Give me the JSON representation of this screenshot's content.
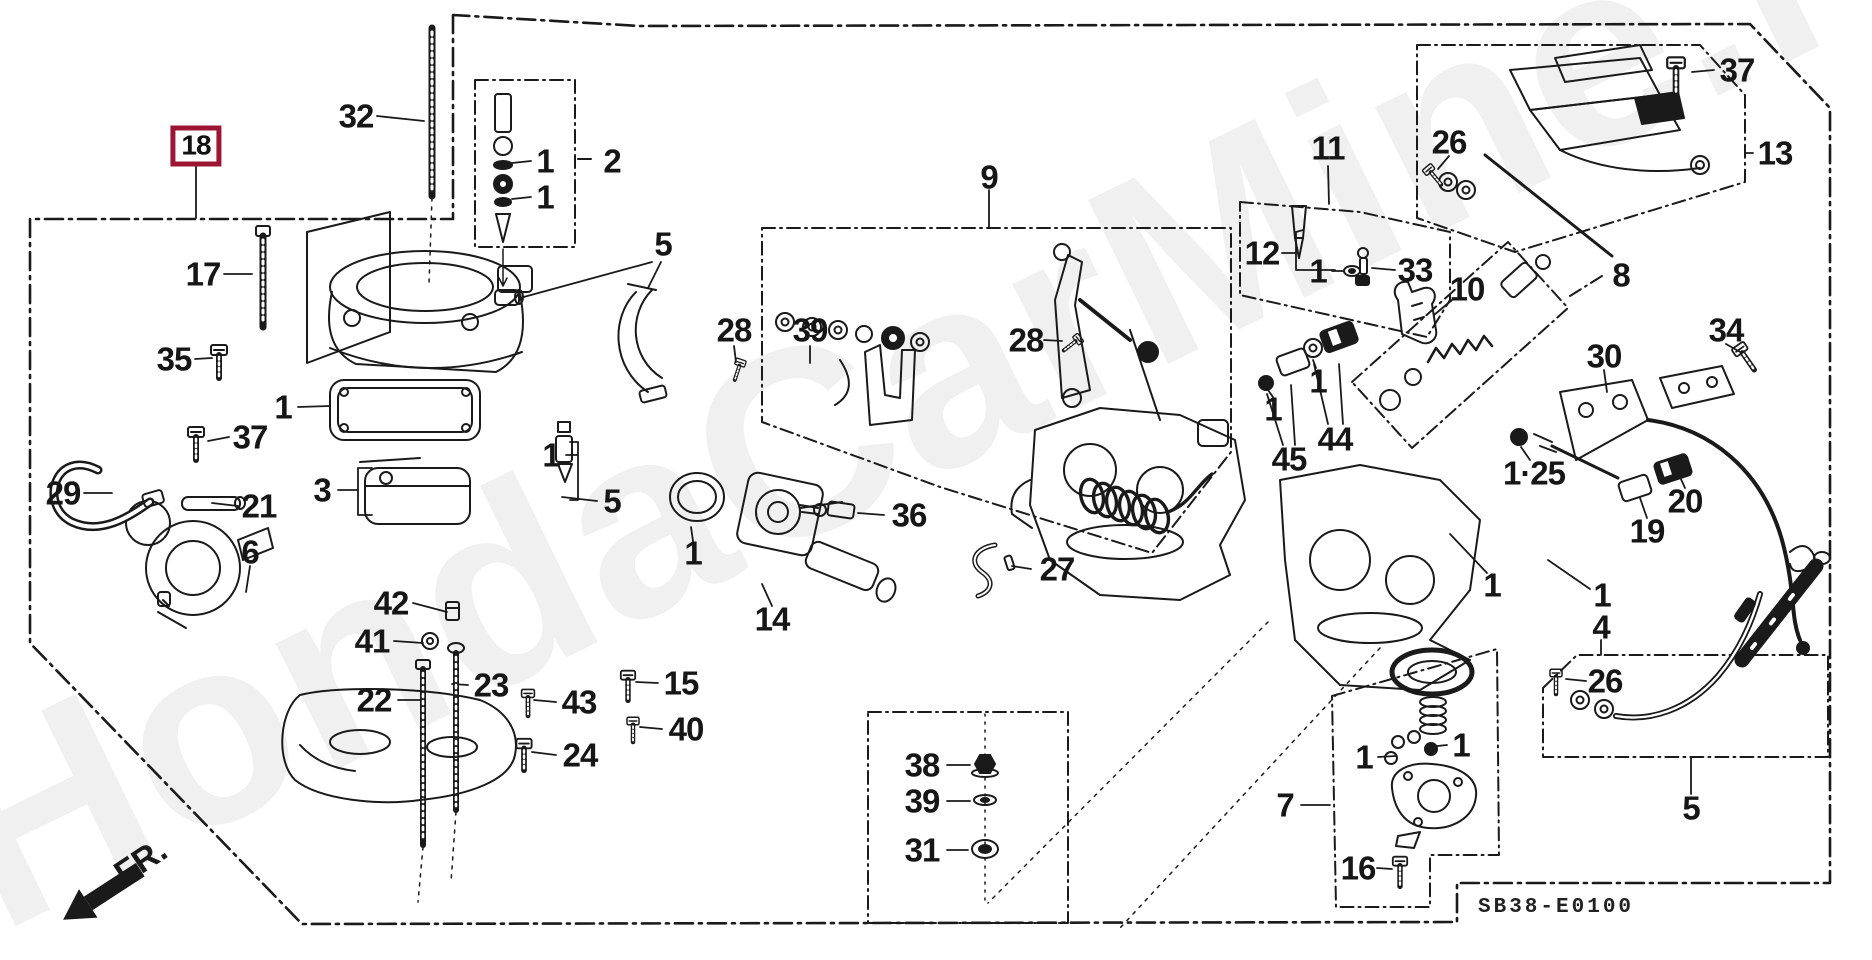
{
  "diagram": {
    "code": "SB38-E0100",
    "watermark": "HondaCarMine.ru",
    "direction_label": "FR.",
    "selected_part": "18",
    "colors": {
      "ink": "#1a1a1a",
      "highlight": "#9c1634",
      "background": "#ffffff",
      "watermark_gray": "#ebebeb"
    },
    "callouts": [
      {
        "text": "18",
        "x": 196,
        "y": 146,
        "boxed": true
      },
      {
        "text": "32",
        "x": 356,
        "y": 116,
        "boxed": false
      },
      {
        "text": "2",
        "x": 612,
        "y": 161,
        "boxed": false
      },
      {
        "text": "1",
        "x": 545,
        "y": 161,
        "boxed": false
      },
      {
        "text": "1",
        "x": 545,
        "y": 197,
        "boxed": false
      },
      {
        "text": "17",
        "x": 203,
        "y": 274,
        "boxed": false
      },
      {
        "text": "35",
        "x": 174,
        "y": 359,
        "boxed": false
      },
      {
        "text": "1",
        "x": 283,
        "y": 407,
        "boxed": false
      },
      {
        "text": "37",
        "x": 250,
        "y": 437,
        "boxed": false
      },
      {
        "text": "29",
        "x": 63,
        "y": 493,
        "boxed": false
      },
      {
        "text": "21",
        "x": 259,
        "y": 506,
        "boxed": false
      },
      {
        "text": "3",
        "x": 322,
        "y": 490,
        "boxed": false
      },
      {
        "text": "6",
        "x": 250,
        "y": 552,
        "boxed": false
      },
      {
        "text": "5",
        "x": 663,
        "y": 244,
        "boxed": false
      },
      {
        "text": "28",
        "x": 734,
        "y": 330,
        "boxed": false
      },
      {
        "text": "39",
        "x": 810,
        "y": 330,
        "boxed": false
      },
      {
        "text": "1",
        "x": 551,
        "y": 455,
        "boxed": false
      },
      {
        "text": "5",
        "x": 612,
        "y": 501,
        "boxed": false
      },
      {
        "text": "1",
        "x": 693,
        "y": 553,
        "boxed": false
      },
      {
        "text": "36",
        "x": 909,
        "y": 515,
        "boxed": false
      },
      {
        "text": "14",
        "x": 772,
        "y": 619,
        "boxed": false
      },
      {
        "text": "27",
        "x": 1057,
        "y": 569,
        "boxed": false
      },
      {
        "text": "42",
        "x": 391,
        "y": 603,
        "boxed": false
      },
      {
        "text": "41",
        "x": 372,
        "y": 641,
        "boxed": false
      },
      {
        "text": "22",
        "x": 374,
        "y": 700,
        "boxed": false
      },
      {
        "text": "23",
        "x": 491,
        "y": 685,
        "boxed": false
      },
      {
        "text": "43",
        "x": 579,
        "y": 702,
        "boxed": false
      },
      {
        "text": "24",
        "x": 580,
        "y": 755,
        "boxed": false
      },
      {
        "text": "15",
        "x": 681,
        "y": 683,
        "boxed": false
      },
      {
        "text": "40",
        "x": 686,
        "y": 729,
        "boxed": false
      },
      {
        "text": "9",
        "x": 989,
        "y": 177,
        "boxed": false
      },
      {
        "text": "28",
        "x": 1026,
        "y": 340,
        "boxed": false
      },
      {
        "text": "11",
        "x": 1328,
        "y": 148,
        "boxed": false
      },
      {
        "text": "12",
        "x": 1262,
        "y": 253,
        "boxed": false
      },
      {
        "text": "1",
        "x": 1318,
        "y": 271,
        "boxed": false
      },
      {
        "text": "33",
        "x": 1415,
        "y": 270,
        "boxed": false
      },
      {
        "text": "10",
        "x": 1467,
        "y": 289,
        "boxed": false
      },
      {
        "text": "26",
        "x": 1449,
        "y": 142,
        "boxed": false
      },
      {
        "text": "37",
        "x": 1737,
        "y": 70,
        "boxed": false
      },
      {
        "text": "13",
        "x": 1775,
        "y": 153,
        "boxed": false
      },
      {
        "text": "8",
        "x": 1621,
        "y": 275,
        "boxed": false
      },
      {
        "text": "34",
        "x": 1726,
        "y": 330,
        "boxed": false
      },
      {
        "text": "30",
        "x": 1604,
        "y": 356,
        "boxed": false
      },
      {
        "text": "45",
        "x": 1289,
        "y": 459,
        "boxed": false
      },
      {
        "text": "44",
        "x": 1335,
        "y": 439,
        "boxed": false
      },
      {
        "text": "1",
        "x": 1273,
        "y": 409,
        "boxed": false
      },
      {
        "text": "1",
        "x": 1318,
        "y": 381,
        "boxed": false
      },
      {
        "text": "1·25",
        "x": 1534,
        "y": 473,
        "boxed": false
      },
      {
        "text": "19",
        "x": 1647,
        "y": 531,
        "boxed": false
      },
      {
        "text": "20",
        "x": 1685,
        "y": 501,
        "boxed": false
      },
      {
        "text": "1",
        "x": 1492,
        "y": 585,
        "boxed": false
      },
      {
        "text": "1",
        "x": 1602,
        "y": 595,
        "boxed": false
      },
      {
        "text": "4",
        "x": 1601,
        "y": 627,
        "boxed": false
      },
      {
        "text": "26",
        "x": 1605,
        "y": 681,
        "boxed": false
      },
      {
        "text": "1",
        "x": 1364,
        "y": 757,
        "boxed": false
      },
      {
        "text": "1",
        "x": 1461,
        "y": 745,
        "boxed": false
      },
      {
        "text": "7",
        "x": 1285,
        "y": 805,
        "boxed": false
      },
      {
        "text": "16",
        "x": 1358,
        "y": 868,
        "boxed": false
      },
      {
        "text": "38",
        "x": 922,
        "y": 765,
        "boxed": false
      },
      {
        "text": "39",
        "x": 922,
        "y": 801,
        "boxed": false
      },
      {
        "text": "31",
        "x": 922,
        "y": 850,
        "boxed": false
      },
      {
        "text": "5",
        "x": 1691,
        "y": 808,
        "boxed": false
      }
    ]
  }
}
